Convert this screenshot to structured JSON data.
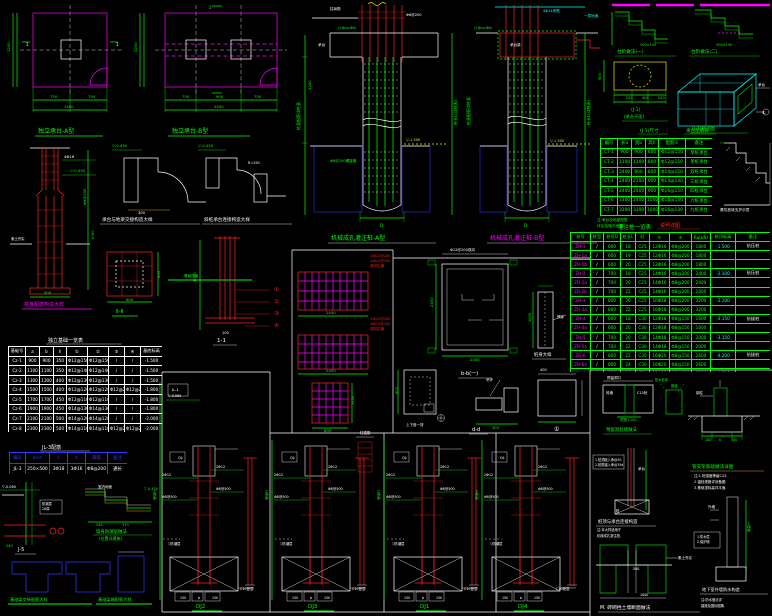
{
  "colors": {
    "g": "#00ff00",
    "w": "#ffffff",
    "r": "#ff2020",
    "m": "#ff00ff",
    "c": "#00ffff",
    "y": "#e8e800",
    "b": "#3535ff"
  },
  "titles": {
    "planA": "独立承台-A型",
    "planB": "独立承台-B型",
    "cage": "桩身配筋构造大样",
    "step1": "承台与地梁交接构造大样",
    "step2": "斜桩承台连接构造大样",
    "sec2": "Ⅱ-Ⅱ",
    "sec11": "1-1",
    "pileA": "机械成孔灌注桩-A型",
    "pileB": "机械成孔灌注桩-B型",
    "bb": "b-b(一)",
    "pstrip": "桩身大样",
    "dd": "d-d",
    "ee": "上下各一排",
    "c1": "①",
    "stepA": "台阶做法(一)",
    "stepB": "台阶做法(二)",
    "yplan1": "(J-1)",
    "yplan2": "(承台平面)",
    "iso": "(J-1)轴测图",
    "capDim": "(J-1)尺寸",
    "capTable": "承台配筋表",
    "redNote": "说明详图",
    "pileTable": "灌注桩一览表",
    "footTable": "独立基础一览表",
    "beamTable": "JL-3配筋",
    "j5": "J-5",
    "dpc1": "墙身防潮层做法",
    "dpc2": "(位置详建施)",
    "tg1": "基础梁交接配筋大样",
    "tg2": "基础梁端配筋大样",
    "dj1": "DJ2",
    "dj2": "DJ3",
    "dj3": "DJ1",
    "dj4": "DJ4",
    "hole": "预留洞封堵做法",
    "support": "管支架基础做法详图",
    "pilecap": "桩顶与承台连接构造",
    "wallwp": "地下室外墙防水构造",
    "mwall": "M. 砖砌挡土墙断面做法"
  },
  "tables": {
    "foot": {
      "widths": [
        17,
        14,
        14,
        13,
        21,
        21,
        16,
        16,
        22
      ],
      "headers": [
        "基础号",
        "a",
        "b",
        "h",
        "①",
        "②",
        "③",
        "④",
        "基底标高"
      ],
      "rows": [
        [
          "Cz-1",
          "900",
          "900",
          "350",
          "Φ12@150",
          "Φ12@150",
          "/",
          "/",
          "-1.500"
        ],
        [
          "Cz-2",
          "1100",
          "1100",
          "350",
          "Φ12@140",
          "Φ12@140",
          "/",
          "/",
          "-1.500"
        ],
        [
          "Cz-3",
          "1300",
          "1300",
          "400",
          "Φ12@130",
          "Φ12@130",
          "/",
          "/",
          "-1.500"
        ],
        [
          "Cz-4",
          "1500",
          "1500",
          "400",
          "Φ12@120",
          "Φ12@120",
          "Φ12@200",
          "Φ12@200",
          "-1.800"
        ],
        [
          "Cz-5",
          "1700",
          "1700",
          "450",
          "Φ12@110",
          "Φ12@110",
          "/",
          "/",
          "-1.800"
        ],
        [
          "Cz-6",
          "1900",
          "1900",
          "450",
          "Φ14@130",
          "Φ14@130",
          "/",
          "/",
          "-1.800"
        ],
        [
          "Cz-7",
          "2100",
          "2100",
          "500",
          "Φ14@120",
          "Φ14@120",
          "/",
          "/",
          "-2.000"
        ],
        [
          "Cz-8",
          "2300",
          "2300",
          "500",
          "Φ14@110",
          "Φ14@110",
          "Φ12@200",
          "Φ12@200",
          "-2.000"
        ]
      ]
    },
    "cap": {
      "widths": [
        17,
        14,
        14,
        13,
        27,
        27
      ],
      "headers": [
        "编号",
        "长a",
        "宽b",
        "高h",
        "配筋①",
        "备注"
      ],
      "rows": [
        [
          "CT-1",
          "900",
          "900",
          "800",
          "Φ12@150",
          "单桩承台"
        ],
        [
          "CT-2",
          "1100",
          "1100",
          "800",
          "Φ12@150",
          "单桩承台"
        ],
        [
          "CT-3",
          "2400",
          "900",
          "800",
          "Φ14@150",
          "双桩承台"
        ],
        [
          "CT-4",
          "2400",
          "2100",
          "900",
          "Φ14@140",
          "三桩承台"
        ],
        [
          "CT-5",
          "2400",
          "2400",
          "900",
          "Φ16@150",
          "四桩承台"
        ],
        [
          "CT-6",
          "3300",
          "2400",
          "1000",
          "Φ16@140",
          "六桩承台"
        ],
        [
          "CT-7",
          "3300",
          "3300",
          "1000",
          "Φ16@130",
          "九桩承台"
        ]
      ]
    },
    "pile": {
      "widths": [
        20,
        13,
        17,
        15,
        14,
        20,
        22,
        19,
        25,
        35
      ],
      "headers": [
        "桩号",
        "桩型",
        "桩径D",
        "桩长L",
        "砼",
        "①",
        "②",
        "Ra(kN)",
        "桩顶标高",
        "备注"
      ],
      "rows": [
        [
          "ZH-1",
          "/",
          "600",
          "18",
          "C25",
          "12Φ16",
          "Φ8@200",
          "1800",
          "-1.500",
          "抗压桩"
        ],
        [
          "ZH-1a",
          "/",
          "600",
          "19",
          "C25",
          "12Φ16",
          "Φ8@200",
          "1800",
          "",
          ""
        ],
        [
          "ZH-1b",
          "/",
          "600",
          "20",
          "C25",
          "12Φ16",
          "Φ8@200",
          "1800",
          "",
          ""
        ],
        [
          "ZH-2",
          "/",
          "700",
          "18",
          "C25",
          "14Φ16",
          "Φ8@200",
          "2400",
          "-2.100",
          "抗压桩"
        ],
        [
          "ZH-2a",
          "/",
          "700",
          "20",
          "C25",
          "14Φ16",
          "Φ8@200",
          "2400",
          "",
          ""
        ],
        [
          "ZH-2b",
          "/",
          "700",
          "22",
          "C25",
          "14Φ16",
          "Φ8@200",
          "2400",
          "",
          ""
        ],
        [
          "ZH-3",
          "/",
          "800",
          "20",
          "C25",
          "16Φ18",
          "Φ8@200",
          "3200",
          "-2.100",
          ""
        ],
        [
          "ZH-3a",
          "/",
          "800",
          "22",
          "C25",
          "16Φ18",
          "Φ8@200",
          "3200",
          "",
          ""
        ],
        [
          "ZH-4",
          "/",
          "600",
          "18",
          "C30",
          "12Φ18",
          "Φ8@150",
          "1600",
          "-3.150",
          "抗拔桩"
        ],
        [
          "ZH-4a",
          "/",
          "600",
          "20",
          "C30",
          "12Φ18",
          "Φ8@150",
          "1600",
          "",
          ""
        ],
        [
          "ZH-5",
          "/",
          "700",
          "20",
          "C30",
          "14Φ18",
          "Φ8@150",
          "2000",
          "-3.150",
          ""
        ],
        [
          "ZH-5a",
          "/",
          "700",
          "22",
          "C30",
          "14Φ18",
          "Φ8@150",
          "2000",
          "",
          ""
        ],
        [
          "ZH-6",
          "/",
          "800",
          "22",
          "C30",
          "16Φ20",
          "Φ8@150",
          "2600",
          "-4.200",
          "抗拔桩"
        ],
        [
          "ZH-6a",
          "/",
          "800",
          "24",
          "C30",
          "16Φ20",
          "Φ8@150",
          "2600",
          "",
          ""
        ],
        [
          "ZH-7",
          "/",
          "900",
          "24",
          "C30",
          "18Φ20",
          "Φ8@150",
          "3200",
          "-4.500",
          ""
        ]
      ]
    },
    "beam": {
      "widths": [
        16,
        24,
        18,
        18,
        22,
        20
      ],
      "headers": [
        "编号",
        "b×h",
        "①",
        "②",
        "箍筋",
        "备注"
      ],
      "rows": [
        [
          "JL-3",
          "250×500",
          "3Φ18",
          "3Φ16",
          "Φ8@200",
          "通长"
        ]
      ]
    }
  },
  "annotations": [
    [
      50,
      98,
      "750",
      "g",
      3.8
    ],
    [
      88,
      98,
      "750",
      "g",
      3.8
    ],
    [
      64,
      108,
      "1500",
      "g",
      3.8
    ],
    [
      10,
      52,
      "1200",
      "g",
      3.8,
      -90
    ],
    [
      26,
      46,
      "1",
      "w",
      4
    ],
    [
      116,
      46,
      "1",
      "w",
      4
    ],
    [
      182,
      98,
      "750",
      "g",
      3.8
    ],
    [
      216,
      98,
      "900",
      "g",
      3.8
    ],
    [
      254,
      98,
      "750",
      "g",
      3.8
    ],
    [
      214,
      108,
      "2400",
      "g",
      3.8
    ],
    [
      137,
      52,
      "1200",
      "g",
      3.8,
      -90
    ],
    [
      209,
      9,
      "2",
      "g",
      4
    ],
    [
      64,
      158,
      "4Φ16",
      "w",
      3.8
    ],
    [
      70,
      172,
      "▽-0.050",
      "g",
      3.8
    ],
    [
      86,
      205,
      "Φ8@200",
      "g",
      3.8,
      -90
    ],
    [
      94,
      240,
      "1000",
      "g",
      3.8,
      -90
    ],
    [
      44,
      294,
      "900",
      "g",
      3.8
    ],
    [
      11,
      240,
      "素土夯实",
      "w",
      3.4
    ],
    [
      112,
      147,
      "▽-0.450",
      "g",
      3.8
    ],
    [
      138,
      214,
      "300",
      "w",
      3.6
    ],
    [
      198,
      147,
      "▽-0.450",
      "g",
      3.8
    ],
    [
      248,
      164,
      "R=250",
      "w",
      3.4
    ],
    [
      160,
      278,
      "600",
      "g",
      3.8,
      -90
    ],
    [
      126,
      301,
      "600",
      "g",
      3.8
    ],
    [
      196,
      282,
      "1500",
      "g",
      3.8,
      -90
    ],
    [
      184,
      277,
      "基础顶面",
      "g",
      3.6
    ],
    [
      274,
      291,
      "①",
      "r",
      5.5
    ],
    [
      274,
      303,
      "②",
      "r",
      5.5
    ],
    [
      274,
      315,
      "③",
      "r",
      5.5
    ],
    [
      274,
      327,
      "④",
      "r",
      5.5
    ],
    [
      222,
      334,
      "100",
      "w",
      3.6
    ],
    [
      330,
      10,
      "柱纵筋",
      "w",
      3.6
    ],
    [
      406,
      16,
      "Φ6@200",
      "w",
      3.6
    ],
    [
      338,
      29,
      "(1Φa×Φb)",
      "g",
      3.6
    ],
    [
      318,
      46,
      "承台",
      "w",
      3.6
    ],
    [
      300,
      130,
      "桩身配筋详桩表",
      "g",
      4,
      -90
    ],
    [
      311,
      90,
      "1200",
      "g",
      3.8,
      -90
    ],
    [
      457,
      125,
      "桩长L(详桩表)",
      "g",
      4,
      -90
    ],
    [
      406,
      141,
      "▽-1.500",
      "y",
      3.6
    ],
    [
      330,
      162,
      "Φ8@200螺旋箍",
      "g",
      3.6
    ],
    [
      380,
      227,
      "D",
      "g",
      4.5
    ],
    [
      543,
      12,
      "4Φ14吊筋",
      "c",
      3.6
    ],
    [
      584,
      17,
      "一层地面",
      "c",
      3.6
    ],
    [
      474,
      29,
      "(1Φa×Φb)",
      "g",
      3.6
    ],
    [
      510,
      46,
      "承台梁",
      "w",
      3.6
    ],
    [
      470,
      125,
      "桩身配筋详桩表",
      "g",
      4,
      -90
    ],
    [
      590,
      125,
      "桩长L(详桩表)",
      "g",
      4,
      -90
    ],
    [
      524,
      227,
      "D",
      "g",
      4.5
    ],
    [
      550,
      142,
      "▽-1.500",
      "y",
      3.6
    ],
    [
      370,
      257,
      "①Φ12@100",
      "r",
      3.5
    ],
    [
      370,
      262,
      "②Φ12@150",
      "r",
      3.5
    ],
    [
      370,
      267,
      "双向拉通",
      "r",
      3.5
    ],
    [
      370,
      320,
      "①Φ12@100",
      "r",
      3.5
    ],
    [
      370,
      325,
      "②Φ12@150",
      "r",
      3.5
    ],
    [
      370,
      330,
      "双向拉通",
      "r",
      3.5
    ],
    [
      326,
      314,
      "2400",
      "g",
      3.8
    ],
    [
      326,
      372,
      "2400",
      "g",
      3.8
    ],
    [
      354,
      405,
      "1200",
      "g",
      3.6,
      -90
    ],
    [
      324,
      432,
      "800",
      "g",
      3.8
    ],
    [
      450,
      251,
      "Φ12@200双向",
      "w",
      3.6
    ],
    [
      433,
      307,
      "2400",
      "g",
      3.8,
      -90
    ],
    [
      470,
      361,
      "2400",
      "g",
      3.8
    ],
    [
      557,
      318,
      "焊接",
      "w",
      3.4
    ],
    [
      531,
      322,
      "1000",
      "g",
      3.6,
      -90
    ],
    [
      398,
      394,
      "600",
      "g",
      3.6,
      -90
    ],
    [
      406,
      426,
      "上下各一排",
      "w",
      3.5
    ],
    [
      486,
      381,
      "吊环",
      "w",
      3.5
    ],
    [
      492,
      429,
      "300",
      "g",
      3.6
    ],
    [
      540,
      371,
      "400",
      "w",
      3.5
    ],
    [
      554,
      431,
      "①",
      "w",
      6
    ],
    [
      640,
      46,
      "300×150",
      "g",
      3.5
    ],
    [
      716,
      46,
      "300×150",
      "g",
      3.5
    ],
    [
      601,
      80,
      "900",
      "g",
      3.6,
      -90
    ],
    [
      626,
      99,
      "250",
      "g",
      3.5
    ],
    [
      642,
      99,
      "400",
      "g",
      3.5
    ],
    [
      658,
      99,
      "250",
      "g",
      3.5
    ],
    [
      758,
      86,
      "承台",
      "w",
      3.5
    ],
    [
      762,
      114,
      "①",
      "w",
      4
    ],
    [
      597,
      221,
      "注:承台及地梁配筋",
      "g",
      3.7
    ],
    [
      597,
      227,
      "详见结施平面图.",
      "g",
      3.7
    ],
    [
      720,
      211,
      "基坑放坡支护示意",
      "w",
      3.7
    ],
    [
      2,
      488,
      "▽-0.060",
      "w",
      3.5
    ],
    [
      42,
      505,
      "防潮层",
      "w",
      3.3
    ],
    [
      42,
      510,
      "20厚",
      "w",
      3.3
    ],
    [
      6,
      547,
      "240",
      "g",
      3.5
    ],
    [
      98,
      488,
      "室内地面",
      "w",
      3.5
    ],
    [
      144,
      490,
      "▽-0.450",
      "g",
      3.5
    ],
    [
      96,
      526,
      "240",
      "g",
      3.5
    ],
    [
      122,
      526,
      "370",
      "g",
      3.5
    ],
    [
      172,
      391,
      "JL-1",
      "w",
      3.6
    ],
    [
      168,
      397,
      "▽-0.060",
      "w",
      3.3
    ],
    [
      360,
      434,
      "柱插筋",
      "w",
      3.5
    ],
    [
      178,
      459,
      "QL",
      "w",
      3.6
    ],
    [
      216,
      468,
      "2Φ12",
      "w",
      3.4
    ],
    [
      216,
      490,
      "Φ8@500",
      "w",
      3.4
    ],
    [
      162,
      476,
      "2Φ12",
      "w",
      3.4
    ],
    [
      162,
      498,
      "Φ8@500",
      "w",
      3.4
    ],
    [
      168,
      545,
      "▽防潮层",
      "w",
      3.3
    ],
    [
      180,
      599,
      "150",
      "w",
      3.2
    ],
    [
      198,
      599,
      "b",
      "w",
      3.2
    ],
    [
      212,
      599,
      "150",
      "w",
      3.2
    ],
    [
      240,
      590,
      "C10垫层",
      "w",
      3.4
    ],
    [
      156,
      500,
      "埋深H",
      "g",
      3.6,
      -90
    ],
    [
      290,
      459,
      "QL",
      "w",
      3.6
    ],
    [
      328,
      468,
      "2Φ12",
      "w",
      3.4
    ],
    [
      328,
      490,
      "Φ8@500",
      "w",
      3.4
    ],
    [
      274,
      476,
      "2Φ12",
      "w",
      3.4
    ],
    [
      274,
      498,
      "Φ8@500",
      "w",
      3.4
    ],
    [
      280,
      545,
      "▽防潮层",
      "w",
      3.3
    ],
    [
      292,
      599,
      "150",
      "w",
      3.2
    ],
    [
      310,
      599,
      "b",
      "w",
      3.2
    ],
    [
      324,
      599,
      "150",
      "w",
      3.2
    ],
    [
      352,
      590,
      "C10垫层",
      "w",
      3.4
    ],
    [
      268,
      500,
      "埋深H",
      "g",
      3.6,
      -90
    ],
    [
      402,
      459,
      "QL",
      "w",
      3.6
    ],
    [
      440,
      468,
      "2Φ12",
      "w",
      3.4
    ],
    [
      440,
      490,
      "Φ8@500",
      "w",
      3.4
    ],
    [
      386,
      476,
      "2Φ12",
      "w",
      3.4
    ],
    [
      386,
      498,
      "Φ8@500",
      "w",
      3.4
    ],
    [
      392,
      545,
      "▽防潮层",
      "w",
      3.3
    ],
    [
      404,
      599,
      "150",
      "w",
      3.2
    ],
    [
      422,
      599,
      "b",
      "w",
      3.2
    ],
    [
      436,
      599,
      "150",
      "w",
      3.2
    ],
    [
      464,
      590,
      "C10垫层",
      "w",
      3.4
    ],
    [
      380,
      500,
      "埋深H",
      "g",
      3.6,
      -90
    ],
    [
      500,
      459,
      "QL",
      "w",
      3.6
    ],
    [
      538,
      468,
      "2Φ12",
      "w",
      3.4
    ],
    [
      538,
      490,
      "Φ8@500",
      "w",
      3.4
    ],
    [
      484,
      476,
      "2Φ12",
      "w",
      3.4
    ],
    [
      484,
      498,
      "Φ8@500",
      "w",
      3.4
    ],
    [
      490,
      545,
      "▽防潮层",
      "w",
      3.3
    ],
    [
      502,
      599,
      "150",
      "w",
      3.2
    ],
    [
      520,
      599,
      "b",
      "w",
      3.2
    ],
    [
      534,
      599,
      "150",
      "w",
      3.2
    ],
    [
      556,
      590,
      "C10垫层",
      "w",
      3.4
    ],
    [
      478,
      500,
      "埋深H",
      "g",
      3.6,
      -90
    ],
    [
      606,
      394,
      "砖墙",
      "w",
      3.5
    ],
    [
      637,
      394,
      "C15砼",
      "w",
      3.5
    ],
    [
      607,
      379,
      "预留洞口",
      "w",
      3.5
    ],
    [
      620,
      421,
      "洞宽+100",
      "g",
      3.5
    ],
    [
      655,
      381,
      "防水砂浆",
      "g",
      3.3
    ],
    [
      671,
      387,
      "嵌缝",
      "g",
      3.3
    ],
    [
      696,
      394,
      "钢柱",
      "w",
      3.5
    ],
    [
      705,
      441,
      "100",
      "g",
      3.3
    ],
    [
      719,
      441,
      "b",
      "g",
      3.3
    ],
    [
      731,
      441,
      "100",
      "g",
      3.3
    ],
    [
      694,
      477,
      "注:1.砼强度等级C25.",
      "w",
      3.5
    ],
    [
      694,
      483,
      "2.锚栓规格详设备图.",
      "w",
      3.5
    ],
    [
      694,
      489,
      "3.基础顶标高详平面.",
      "w",
      3.5
    ],
    [
      595,
      461,
      "1.桩顶嵌入承台50.",
      "w",
      3.2
    ],
    [
      595,
      466,
      "2.桩筋锚入承台35d.",
      "w",
      3.2
    ],
    [
      638,
      470,
      "承台",
      "w",
      3.5
    ],
    [
      616,
      512,
      "桩",
      "w",
      3.5
    ],
    [
      597,
      531,
      "注:本大样适用于",
      "w",
      3.3
    ],
    [
      597,
      537,
      "机械成孔灌注桩.",
      "w",
      3.3
    ],
    [
      697,
      538,
      "1.防水层",
      "w",
      3.2
    ],
    [
      697,
      543,
      "2.保护墙",
      "w",
      3.2
    ],
    [
      750,
      532,
      "墙高H",
      "g",
      3.5,
      -90
    ],
    [
      708,
      508,
      "外墙",
      "w",
      3.5
    ],
    [
      701,
      601,
      "注:防水做法详",
      "w",
      3.3
    ],
    [
      701,
      607,
      "建施及国标图集.",
      "w",
      3.3
    ],
    [
      678,
      559,
      "素土夯实",
      "w",
      3.5
    ],
    [
      633,
      570,
      "500",
      "w",
      3.3
    ],
    [
      640,
      596,
      "1000",
      "w",
      3.3
    ]
  ]
}
